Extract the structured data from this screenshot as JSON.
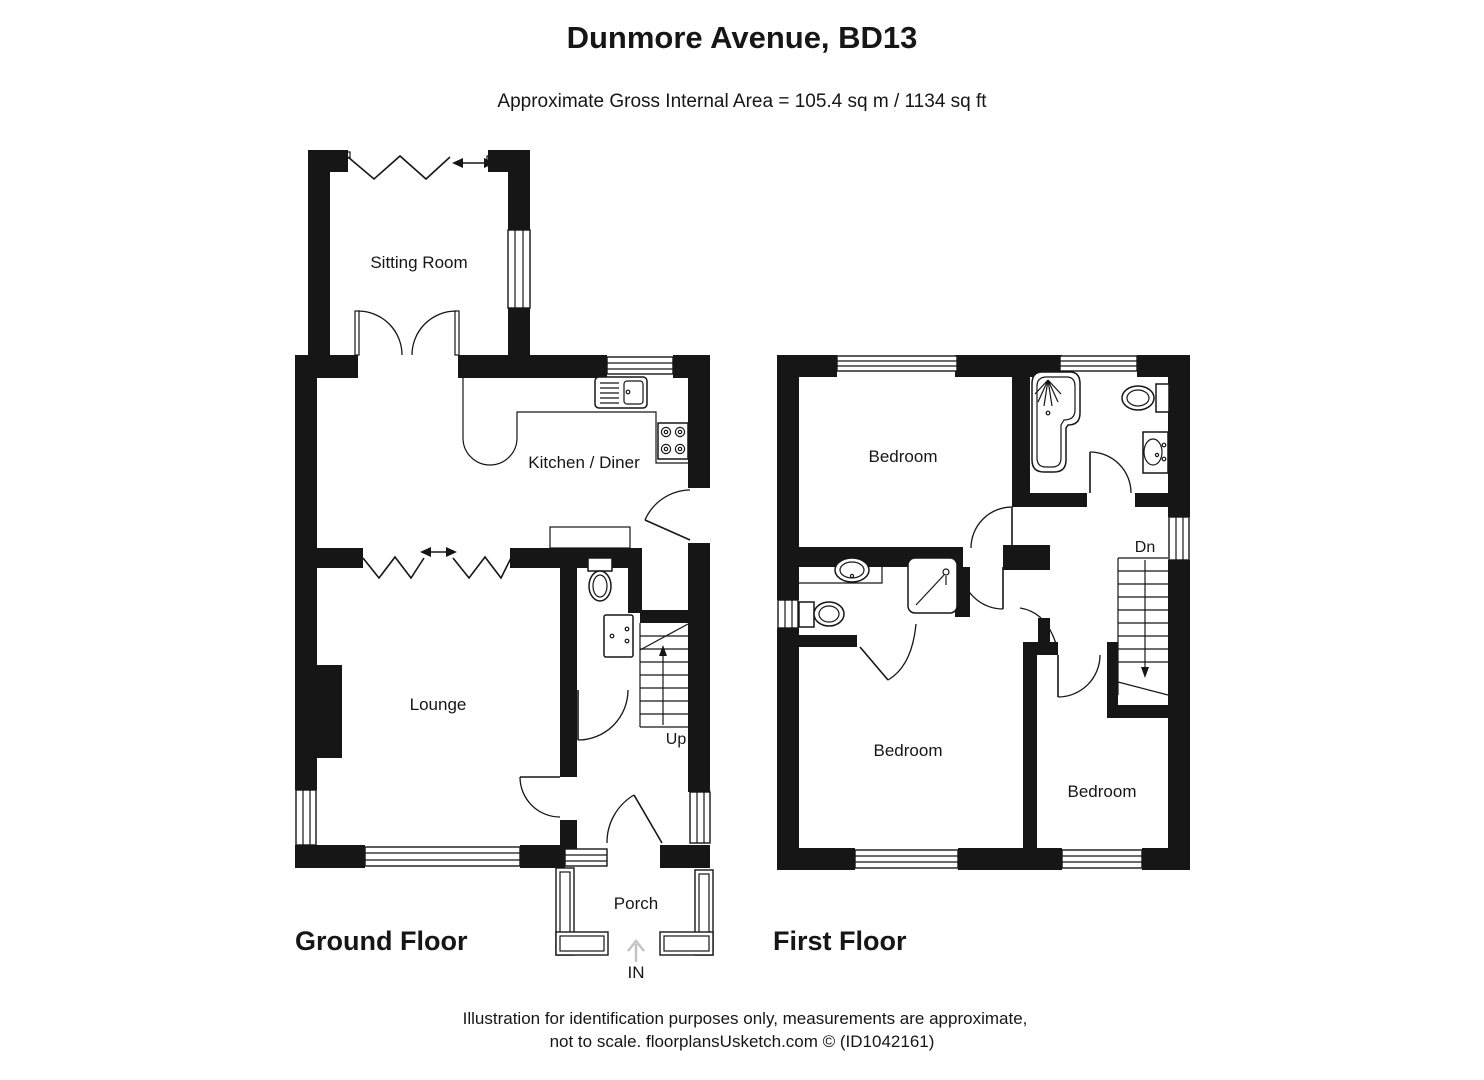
{
  "title": "Dunmore Avenue, BD13",
  "subtitle": "Approximate Gross Internal Area = 105.4 sq m / 1134 sq ft",
  "colors": {
    "ink": "#161616",
    "entry_arrow_gray": "#c4c4c4"
  },
  "ground_floor": {
    "name": "Ground Floor",
    "rooms": {
      "sitting_room": "Sitting Room",
      "kitchen_diner": "Kitchen / Diner",
      "lounge": "Lounge",
      "porch": "Porch"
    },
    "stairs_label": "Up",
    "entrance_label": "IN"
  },
  "first_floor": {
    "name": "First Floor",
    "rooms": {
      "bedroom_1": "Bedroom",
      "bedroom_2": "Bedroom",
      "bedroom_3": "Bedroom"
    },
    "stairs_label": "Dn"
  },
  "footer": {
    "line1": "Illustration for identification purposes only, measurements are approximate,",
    "line2": "not to scale. floorplansUsketch.com © (ID1042161)"
  }
}
